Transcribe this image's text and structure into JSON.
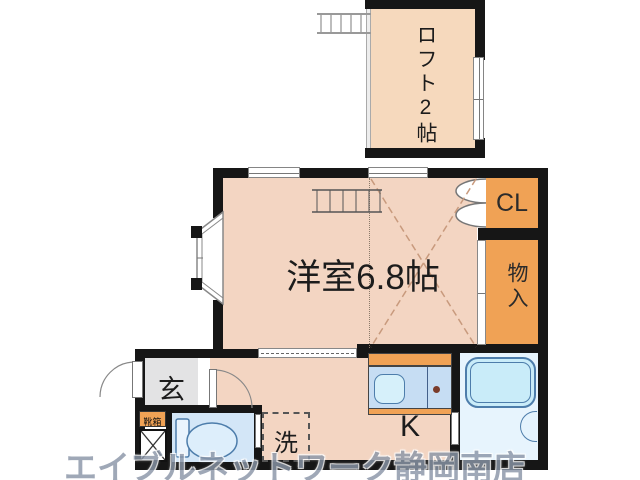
{
  "floorplan": {
    "labels": {
      "loft": "ロフト2帖",
      "main_room": "洋室6.8帖",
      "closet": "CL",
      "storage": "物入",
      "entrance": "玄",
      "shoebox": "靴箱",
      "laundry": "洗",
      "kitchen": "K"
    },
    "watermark": "エイブルネットワーク静岡南店",
    "colors": {
      "room_peach": "#f3d5c2",
      "loft_peach": "#f6d9bd",
      "accent_orange": "#f0a255",
      "counter_blue": "#c6ddf3",
      "sink_blue": "#d6f0fa",
      "bath_floor": "#e7f4fd",
      "tub_blue": "#c9ecf9",
      "toilet_floor": "#d3e6f7",
      "fixture_blue": "#4d7dab",
      "entrance_gray": "#e3e3e4",
      "wall_black": "#161616",
      "watermark_gray": "#8b96a8",
      "dash_tan": "#c89a7d"
    }
  }
}
